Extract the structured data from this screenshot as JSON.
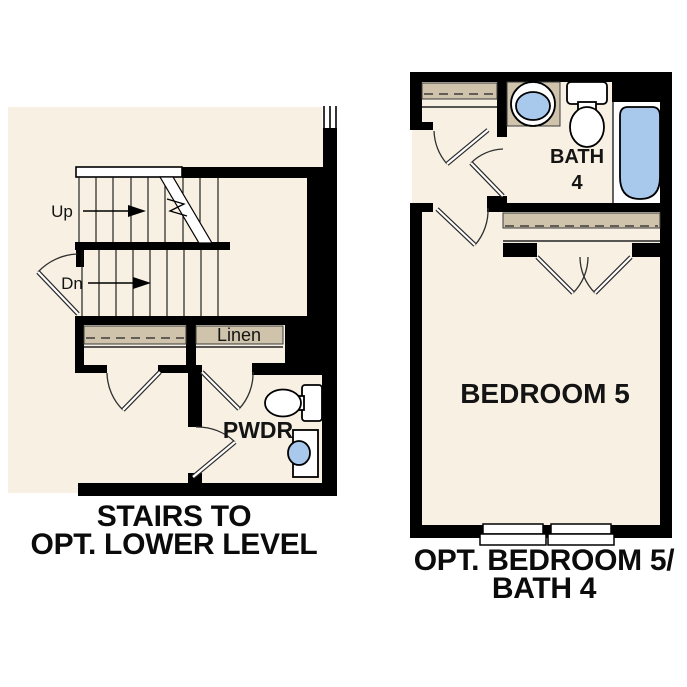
{
  "plans": {
    "left": {
      "caption_line1": "STAIRS TO",
      "caption_line2": "OPT. LOWER LEVEL",
      "labels": {
        "up": "Up",
        "dn": "Dn",
        "linen": "Linen",
        "pwdr": "PWDR"
      }
    },
    "right": {
      "caption_line1": "OPT. BEDROOM 5/",
      "caption_line2": "BATH 4",
      "labels": {
        "bath_line1": "BATH",
        "bath_line2": "4",
        "bedroom": "BEDROOM 5"
      }
    }
  },
  "icons": [
    "stairs-up",
    "stairs-down",
    "stair-break",
    "door-swing",
    "window-break",
    "toilet",
    "sink-vanity",
    "pedestal-sink",
    "bathtub",
    "window",
    "linen-shelf",
    "closet-shelf"
  ],
  "colors": {
    "floor": "#f7f0e3",
    "shelf": "#cfc3ab",
    "blue": "#a9c9ec",
    "wall": "#000000",
    "text": "#141414"
  }
}
